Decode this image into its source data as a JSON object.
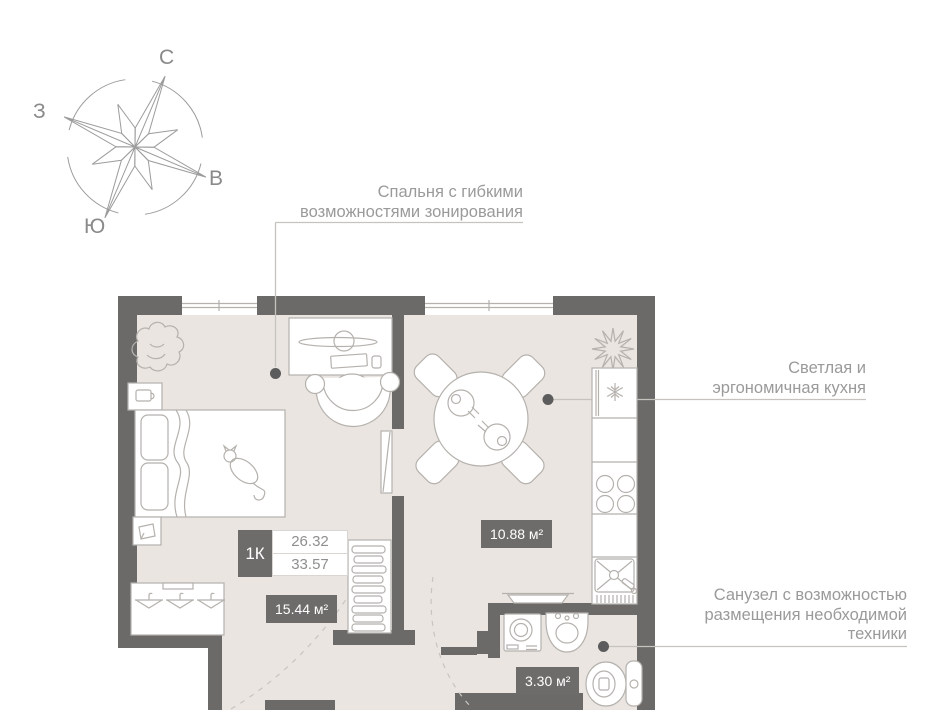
{
  "compass": {
    "north": "С",
    "south": "Ю",
    "west": "З",
    "east": "В"
  },
  "annotations": {
    "bedroom": {
      "line1": "Спальня с гибкими",
      "line2": "возможностями зонирования"
    },
    "kitchen": {
      "line1": "Светлая  и",
      "line2": "эргономичная кухня"
    },
    "bathroom": {
      "line1": "Санузел с возможностью",
      "line2": "размещения необходимой",
      "line3": "техники"
    }
  },
  "apartment": {
    "type_label": "1К",
    "area_value_top": "26.32",
    "area_value_bottom": "33.57"
  },
  "room_areas": {
    "bedroom": "15.44 м²",
    "kitchen": "10.88 м²",
    "bathroom": "3.30 м²"
  },
  "colors": {
    "wall": "#6b6a68",
    "floor": "#eae5e1",
    "label_bg": "#6d6c6a",
    "annotation_text": "#9a9a9a",
    "line_art": "#b5b1ad"
  }
}
